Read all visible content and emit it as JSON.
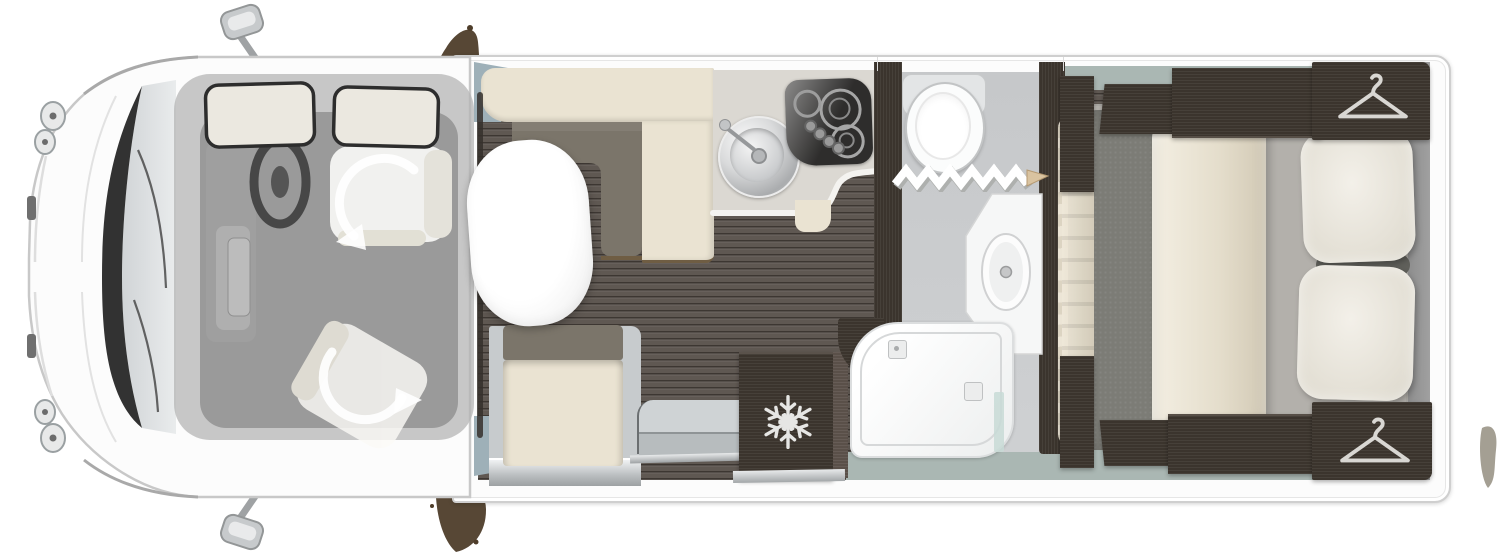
{
  "document": {
    "title": "Motorhome top-view floor plan",
    "orientation": "cab at front-left, bedroom at rear-right",
    "visible_text": "none"
  },
  "colors": {
    "bodyWhite": "#fcfcfc",
    "outline": "#cfcfcf",
    "woodFloor": "#5f5852",
    "darkWood": "#3b342d",
    "cream": "#eae3d2",
    "olive": "#7b756a",
    "counter": "#dbd8d2",
    "counterEdge": "#f4f3f0",
    "bathFloor": "#c6c8ca",
    "bathTeal": "#aab7b3",
    "fixtureWhite": "#fbfcfc",
    "steel": "#c7cbcd",
    "duvet": "#7c7c76",
    "blanket": "#e7e1d3",
    "pillow": "#edeae2",
    "mattress": "#b3b0ab",
    "hob": "#2e2d2c",
    "smudge": "#4e3d2a",
    "bulkhead": "#9eb0b8",
    "glassTeal": "#c8dbd6",
    "rearShadow": "#909090",
    "iconLight": "#e2e0dc",
    "overlayGray": "#8d8d8d"
  },
  "cab": {
    "label": "Driver cab",
    "features": [
      "left-wing-mirror",
      "right-wing-mirror",
      "windscreen",
      "wipers",
      "headlights",
      "steering-wheel",
      "dashboard",
      "driver-swivel-seat",
      "passenger-swivel-seat",
      "headrest-pillow-left",
      "headrest-pillow-right"
    ],
    "seat_rotation_indicator": "white curved swivel arrows on both seats"
  },
  "lounge": {
    "label": "Lounge dinette",
    "bench": "L-shaped bench, cream upholstery with olive seat pads",
    "table": "white oval pedestal table",
    "travel_seat": "forward-facing belted seat with olive headrest",
    "entry": "side entrance door with moulded step"
  },
  "kitchen": {
    "label": "Kitchen",
    "worktop": "curved light-grey worktop",
    "sink": "round stainless-steel sink with swivel tap",
    "hob": {
      "type": "gas hob",
      "burners": 3,
      "control_knobs": 4
    },
    "fridge": {
      "type": "refrigerator",
      "icon": "snowflake-icon"
    }
  },
  "washroom": {
    "label": "Washroom",
    "toilet": "cassette toilet",
    "door": "white concertina folding door with wood pull",
    "basin": "corner vanity with oval basin",
    "shower": "walk-in shower tray with glass screen",
    "floor": "light grey with teal threshold"
  },
  "bedroom": {
    "label": "Rear bedroom",
    "bed": "island double bed",
    "bedding": [
      "grey duvet",
      "folded cream runner blanket",
      "white pillow upper",
      "white pillow lower"
    ],
    "wardrobes": [
      {
        "position": "offside front",
        "icon": "hanger-icon"
      },
      {
        "position": "offside rear",
        "icon": "hanger-icon"
      }
    ],
    "surround": "dark wood bed-surround lockers and steps"
  },
  "decor": {
    "floor_living": "dark wood planks",
    "walls": "dark wood partitions",
    "marks": [
      "mud-smudge-top",
      "mud-smudge-bottom",
      "mud-smudge-right"
    ]
  }
}
